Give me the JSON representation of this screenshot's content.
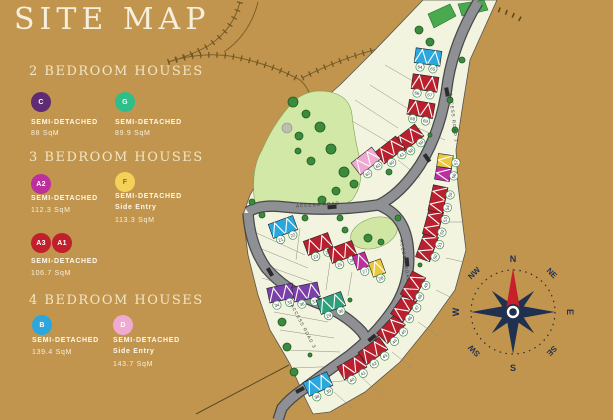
{
  "title": "SITE MAP",
  "colors": {
    "background": "#c2954e",
    "parcel": "#f3f4df",
    "park": "#d2e8a6",
    "road": "#8f9093",
    "road_edge": "#47484a",
    "compass_star": "#20304f",
    "compass_needle": "#c8202a"
  },
  "legend": {
    "sections": [
      {
        "heading": "2 BEDROOM HOUSES",
        "items": [
          {
            "code": "C",
            "color": "#5f2b74",
            "line1": "SEMI-DETACHED",
            "line2": "88 SqM"
          },
          {
            "code": "G",
            "color": "#2fbe8a",
            "line1": "SEMI-DETACHED",
            "line2": "89.9 SqM"
          }
        ]
      },
      {
        "heading": "3 BEDROOM HOUSES",
        "items": [
          {
            "code": "A2",
            "color": "#bd2f9e",
            "line1": "SEMI-DETACHED",
            "line2": "112.3 SqM"
          },
          {
            "code": "F",
            "color": "#f4d158",
            "line1": "SEMI-DETACHED",
            "line2": "Side Entry",
            "line3": "113.3 SqM"
          },
          {
            "code": "A3",
            "code2": "A1",
            "color": "#c0202c",
            "line1": "SEMI-DETACHED",
            "line2": "106.7 SqM"
          }
        ]
      },
      {
        "heading": "4 BEDROOM HOUSES",
        "items": [
          {
            "code": "B",
            "color": "#2aa7de",
            "line1": "SEMI-DETACHED",
            "line2": "139.4 SqM"
          },
          {
            "code": "D",
            "color": "#f0a9d0",
            "line1": "SEMI-DETACHED",
            "line2": "Side Entry",
            "line3": "143.7 SqM"
          }
        ]
      }
    ]
  },
  "site_plan": {
    "road_labels": [
      {
        "text": "ACCESS ROAD 1",
        "x": 452,
        "y": 118,
        "rot": 83
      },
      {
        "text": "ACCESS ROAD",
        "x": 318,
        "y": 206,
        "rot": -4
      },
      {
        "text": "ACCESS ROAD 2",
        "x": 404,
        "y": 264,
        "rot": 80
      },
      {
        "text": "ACCESS ROAD 3",
        "x": 302,
        "y": 327,
        "rot": 62
      }
    ],
    "house_colors": {
      "red": "#b8202e",
      "blue": "#2aa7de",
      "pink": "#f0a9d0",
      "magenta": "#bd2f9e",
      "yellow": "#ecc83d",
      "purple": "#7a3fa8",
      "teal": "#2f9f7b"
    },
    "houses": [
      {
        "x": 428,
        "y": 57,
        "r": 8,
        "t": "blue",
        "p": [
          "64",
          "65"
        ]
      },
      {
        "x": 425,
        "y": 83,
        "r": 8,
        "t": "red",
        "p": [
          "66",
          "67"
        ]
      },
      {
        "x": 421,
        "y": 109,
        "r": 10,
        "t": "red",
        "p": [
          "68",
          "69"
        ]
      },
      {
        "x": 409,
        "y": 138,
        "r": -38,
        "t": "red",
        "p": [
          "58",
          "59"
        ]
      },
      {
        "x": 390,
        "y": 150,
        "r": -38,
        "t": "red",
        "p": [
          "60",
          "61"
        ]
      },
      {
        "x": 366,
        "y": 161,
        "r": -38,
        "t": "pink",
        "p": [
          "62",
          "63"
        ]
      },
      {
        "x": 283,
        "y": 227,
        "r": -20,
        "t": "blue",
        "p": [
          "21",
          "22"
        ]
      },
      {
        "x": 318,
        "y": 244,
        "r": -20,
        "t": "red",
        "p": [
          "23",
          "24"
        ]
      },
      {
        "x": 342,
        "y": 252,
        "r": -20,
        "t": "red",
        "p": [
          "25",
          "26"
        ]
      },
      {
        "x": 361,
        "y": 261,
        "r": -20,
        "t": "magenta",
        "p": [
          "27"
        ]
      },
      {
        "x": 377,
        "y": 268,
        "r": -20,
        "t": "yellow",
        "p": [
          "28"
        ]
      },
      {
        "x": 281,
        "y": 293,
        "r": -12,
        "t": "purple",
        "p": [
          "34",
          "35"
        ]
      },
      {
        "x": 306,
        "y": 292,
        "r": -12,
        "t": "purple",
        "p": [
          "36",
          "37"
        ]
      },
      {
        "x": 331,
        "y": 303,
        "r": -20,
        "t": "teal",
        "p": [
          "29",
          "30"
        ]
      },
      {
        "x": 318,
        "y": 384,
        "r": -25,
        "t": "blue",
        "p": [
          "38",
          "39"
        ]
      },
      {
        "x": 352,
        "y": 367,
        "r": -30,
        "t": "red",
        "p": [
          "40",
          "41"
        ]
      },
      {
        "x": 373,
        "y": 351,
        "r": -36,
        "t": "red",
        "p": [
          "42",
          "43"
        ]
      },
      {
        "x": 391,
        "y": 329,
        "r": -46,
        "t": "red",
        "p": [
          "44",
          "45"
        ]
      },
      {
        "x": 404,
        "y": 307,
        "r": -56,
        "t": "red",
        "p": [
          "46",
          "47"
        ]
      },
      {
        "x": 413,
        "y": 286,
        "r": -62,
        "t": "red",
        "p": [
          "48",
          "49"
        ]
      },
      {
        "x": 427,
        "y": 247,
        "r": -70,
        "t": "red",
        "p": [
          "50",
          "51"
        ]
      },
      {
        "x": 433,
        "y": 223,
        "r": -75,
        "t": "red",
        "p": [
          "52",
          "53"
        ]
      },
      {
        "x": 438,
        "y": 199,
        "r": -78,
        "t": "red",
        "p": [
          "54",
          "55"
        ]
      },
      {
        "x": 443,
        "y": 174,
        "r": -80,
        "t": "magenta",
        "p": [
          "56"
        ]
      },
      {
        "x": 445,
        "y": 161,
        "r": -82,
        "t": "yellow",
        "p": [
          "57"
        ]
      }
    ],
    "trees": [
      {
        "x": 293,
        "y": 102,
        "r": 5
      },
      {
        "x": 306,
        "y": 114,
        "r": 4
      },
      {
        "x": 320,
        "y": 127,
        "r": 5
      },
      {
        "x": 299,
        "y": 136,
        "r": 4
      },
      {
        "x": 331,
        "y": 149,
        "r": 5
      },
      {
        "x": 311,
        "y": 161,
        "r": 4
      },
      {
        "x": 344,
        "y": 172,
        "r": 5
      },
      {
        "x": 298,
        "y": 151,
        "r": 3
      },
      {
        "x": 336,
        "y": 191,
        "r": 4
      },
      {
        "x": 354,
        "y": 184,
        "r": 4
      },
      {
        "x": 322,
        "y": 200,
        "r": 4
      },
      {
        "x": 282,
        "y": 322,
        "r": 4
      },
      {
        "x": 287,
        "y": 347,
        "r": 4
      },
      {
        "x": 294,
        "y": 372,
        "r": 4
      },
      {
        "x": 430,
        "y": 42,
        "r": 4
      },
      {
        "x": 419,
        "y": 30,
        "r": 4
      },
      {
        "x": 389,
        "y": 172,
        "r": 3
      },
      {
        "x": 368,
        "y": 238,
        "r": 4
      },
      {
        "x": 381,
        "y": 242,
        "r": 3
      },
      {
        "x": 340,
        "y": 218,
        "r": 3
      },
      {
        "x": 305,
        "y": 218,
        "r": 3
      },
      {
        "x": 262,
        "y": 215,
        "r": 3
      },
      {
        "x": 252,
        "y": 202,
        "r": 3
      },
      {
        "x": 447,
        "y": 160,
        "r": 3
      },
      {
        "x": 455,
        "y": 130,
        "r": 3
      },
      {
        "x": 450,
        "y": 100,
        "r": 3
      },
      {
        "x": 462,
        "y": 60,
        "r": 3
      },
      {
        "x": 345,
        "y": 230,
        "r": 3
      },
      {
        "x": 398,
        "y": 218,
        "r": 3
      },
      {
        "x": 350,
        "y": 300,
        "r": 2
      },
      {
        "x": 310,
        "y": 355,
        "r": 2
      },
      {
        "x": 420,
        "y": 265,
        "r": 2
      },
      {
        "x": 430,
        "y": 135,
        "r": 2
      }
    ]
  },
  "compass": {
    "directions": {
      "n": "N",
      "ne": "NE",
      "e": "E",
      "se": "SE",
      "s": "S",
      "sw": "SW",
      "w": "W",
      "nw": "NW"
    }
  }
}
